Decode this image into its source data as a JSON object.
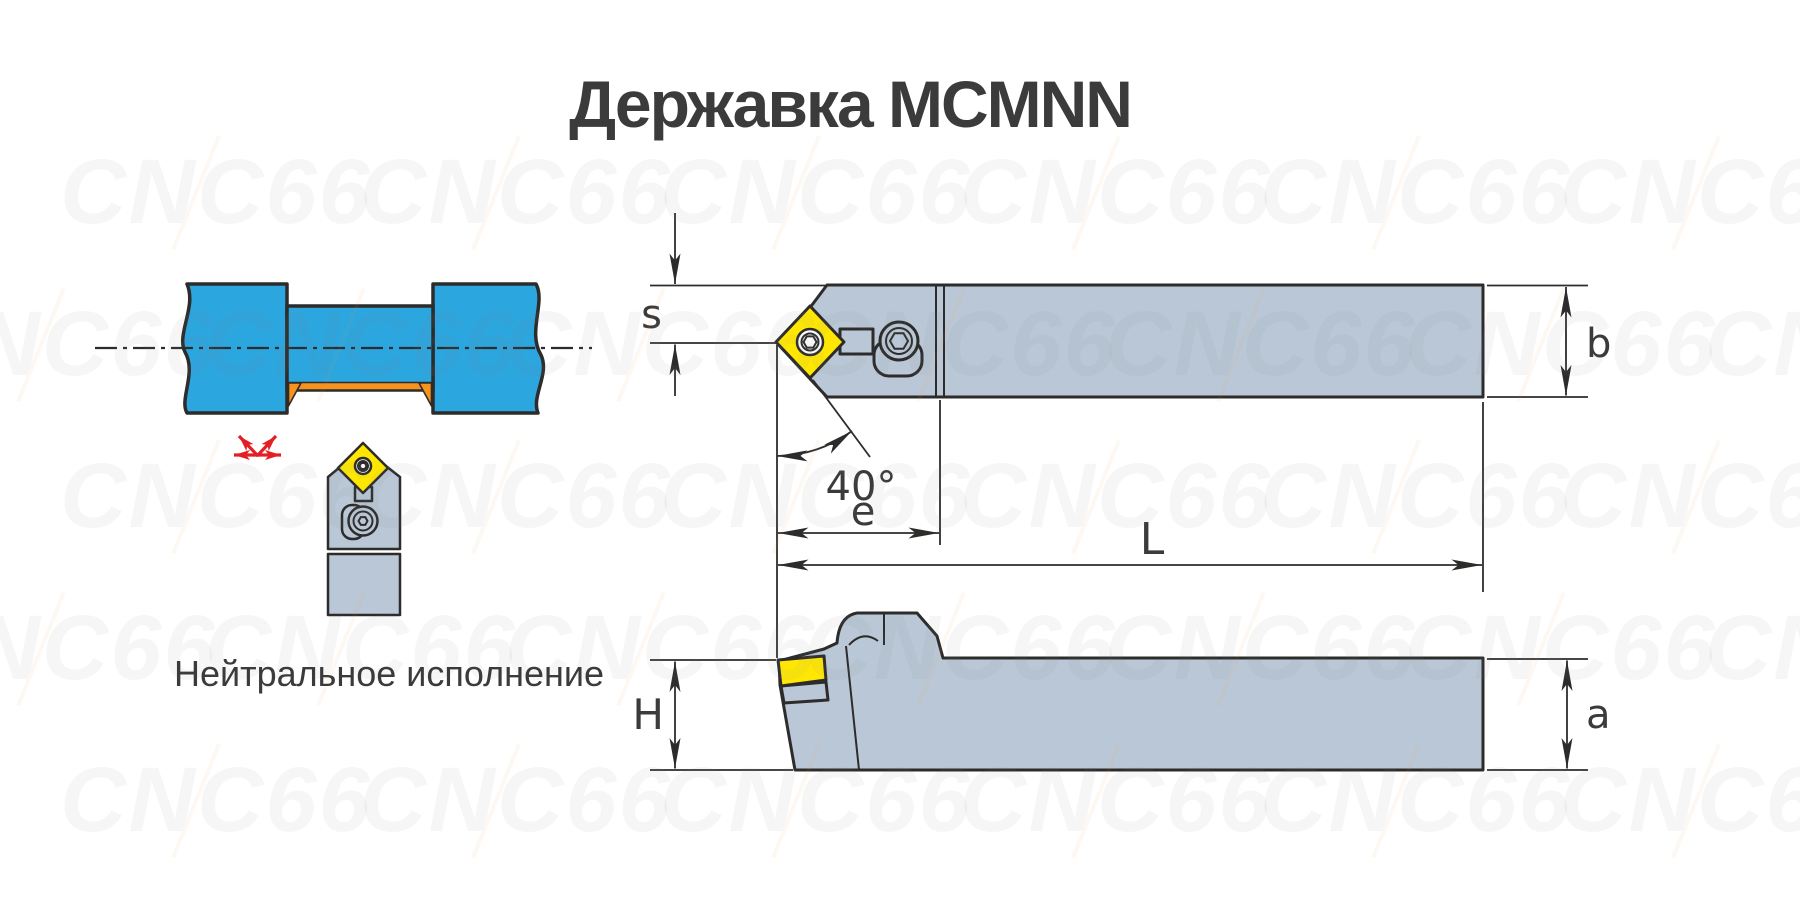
{
  "title": "Державка MCMNN",
  "caption": "Нейтральное исполнение",
  "watermark": {
    "text": "CNC66"
  },
  "dimension_labels": {
    "insert_thickness": "s",
    "approach_angle": "40°",
    "head_length": "e",
    "total_length": "L",
    "shank_width": "b",
    "shank_height": "H",
    "shank_height_right": "a"
  },
  "colors": {
    "outline": "#2d2c2b",
    "dimtext": "#3b3b3b",
    "holder": "#b9c7d6",
    "yellow": "#ffe703",
    "blue": "#2ca6df",
    "orange": "#f6921e",
    "red": "#e31e25",
    "wmgray": "#8a8a8a",
    "wmaccent": "#f49a4a"
  }
}
